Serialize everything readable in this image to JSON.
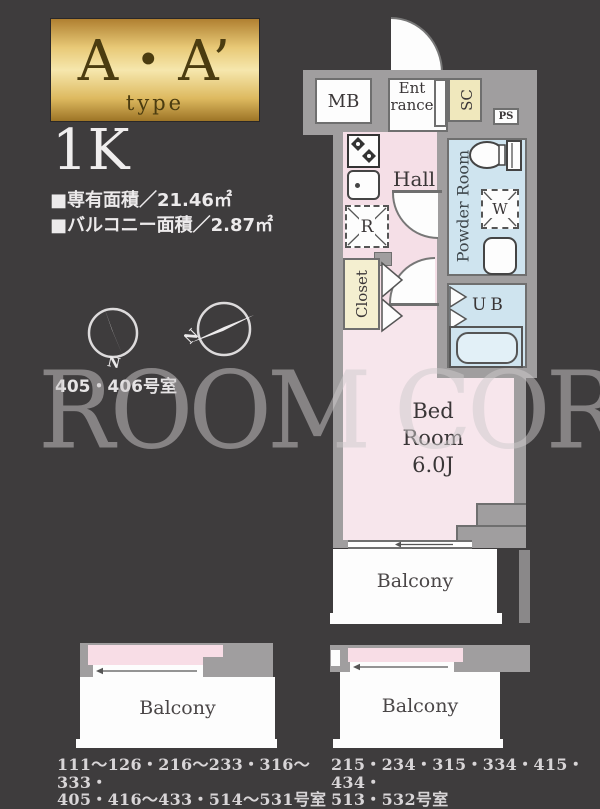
{
  "header": {
    "type_name": "A・A’",
    "type_word": "type",
    "layout_type": "1K",
    "exclusive_area": "■専有面積／21.46㎡",
    "balcony_area": "■バルコニー面積／2.87㎡",
    "compass_label_1": "N",
    "compass_label_2": "N",
    "room_numbers": "405・406号室"
  },
  "watermark": "ROOM CORE",
  "plan": {
    "mb": "MB",
    "entrance_1": "Ent",
    "entrance_2": "rance",
    "shoe_closet": "SC",
    "pipe_space": "PS",
    "hall": "Hall",
    "powder_room": "Powder Room",
    "refrigerator": "R",
    "washing_machine": "W",
    "unit_bath": "UB",
    "closet": "Closet",
    "bedroom_1": "Bed",
    "bedroom_2": "Room",
    "bedroom_3": "6.0J",
    "balcony": "Balcony"
  },
  "mini_plans": {
    "left": {
      "balcony": "Balcony",
      "rooms_line1": "111〜126・216〜233・316〜333・",
      "rooms_line2": "405・416〜433・514〜531号室"
    },
    "right": {
      "balcony": "Balcony",
      "rooms_line1": "215・234・315・334・415・434・",
      "rooms_line2": "513・532号室"
    }
  },
  "colors": {
    "background": "#3e3c3d",
    "wall": "#a09e9f",
    "room_pink": "#f5dfe7",
    "room_blue": "#cfe4ef",
    "shoe_closet_yellow": "#f0e8bd",
    "closet_yellow": "#f4efd0",
    "gold_dark": "#b08031",
    "gold_light": "#f6e7ad"
  }
}
